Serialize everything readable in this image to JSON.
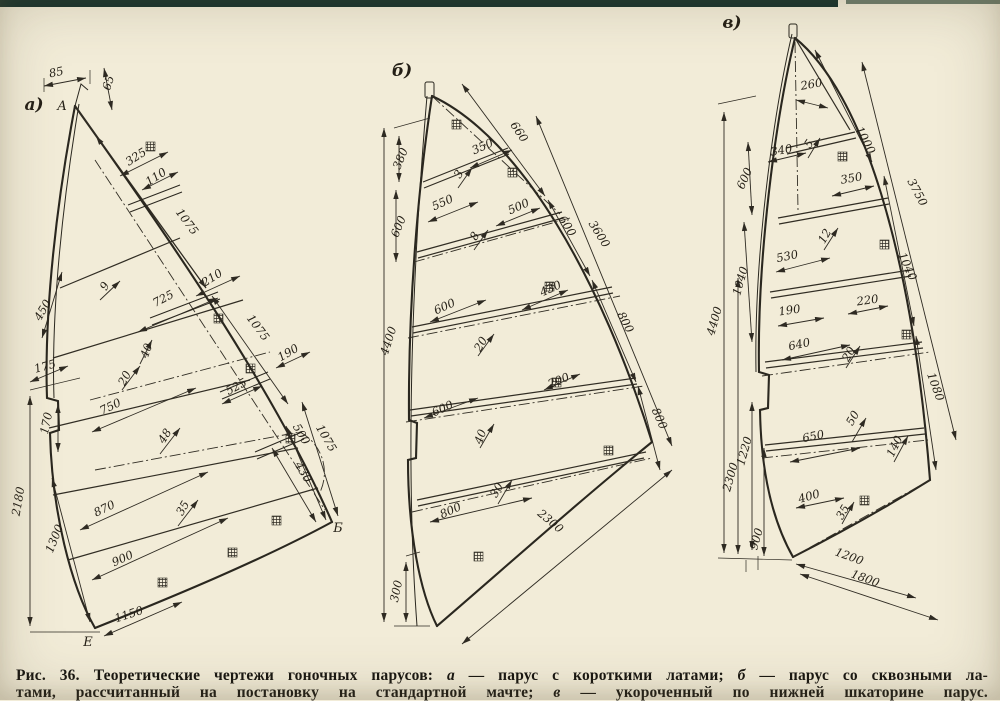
{
  "figure": {
    "number": "Рис. 36.",
    "subject": "Теоретические чертежи гоночных парусов"
  },
  "caption": {
    "line1": [
      {
        "t": "Рис. 36."
      },
      {
        "t": "Теоретические чертежи гоночных парусов: "
      },
      {
        "t": "а"
      },
      {
        "t": " — парус с короткими латами; "
      },
      {
        "t": "б"
      },
      {
        "t": " — парус со сквозными ла-"
      }
    ],
    "line2": [
      {
        "t": "тами, рассчитанный на постановку на стандартной мачте; "
      },
      {
        "t": "в"
      },
      {
        "t": " — укороченный по нижней шкаторине парус."
      }
    ]
  },
  "colors": {
    "paper": "#f2ecd8",
    "ink": "#2a271f",
    "scan_strip": "#17322d"
  },
  "sails": [
    {
      "panel_label": "а)",
      "points": {
        "head": "А",
        "clew": "Б",
        "tack": "Е"
      },
      "dims": [
        "85",
        "65",
        "325",
        "110",
        "1075",
        "210",
        "450",
        "9",
        "725",
        "40",
        "1075",
        "190",
        "175",
        "20",
        "525",
        "750",
        "48",
        "500",
        "1075",
        "430",
        "870",
        "35",
        "170",
        "2180",
        "1300",
        "900",
        "1150"
      ]
    },
    {
      "panel_label": "б)",
      "dims": [
        "380",
        "600",
        "4400",
        "660",
        "350",
        "3",
        "550",
        "500",
        "8",
        "600",
        "3600",
        "600",
        "430",
        "20",
        "800",
        "200",
        "800",
        "600",
        "40",
        "30",
        "800",
        "2300",
        "300"
      ]
    },
    {
      "panel_label": "в)",
      "dims": [
        "260",
        "1000",
        "340",
        "5",
        "600",
        "350",
        "3750",
        "530",
        "12",
        "1040",
        "1040",
        "190",
        "220",
        "640",
        "20",
        "1080",
        "4400",
        "1220",
        "2300",
        "650",
        "50",
        "140",
        "400",
        "35",
        "900",
        "1200",
        "1800"
      ]
    }
  ]
}
